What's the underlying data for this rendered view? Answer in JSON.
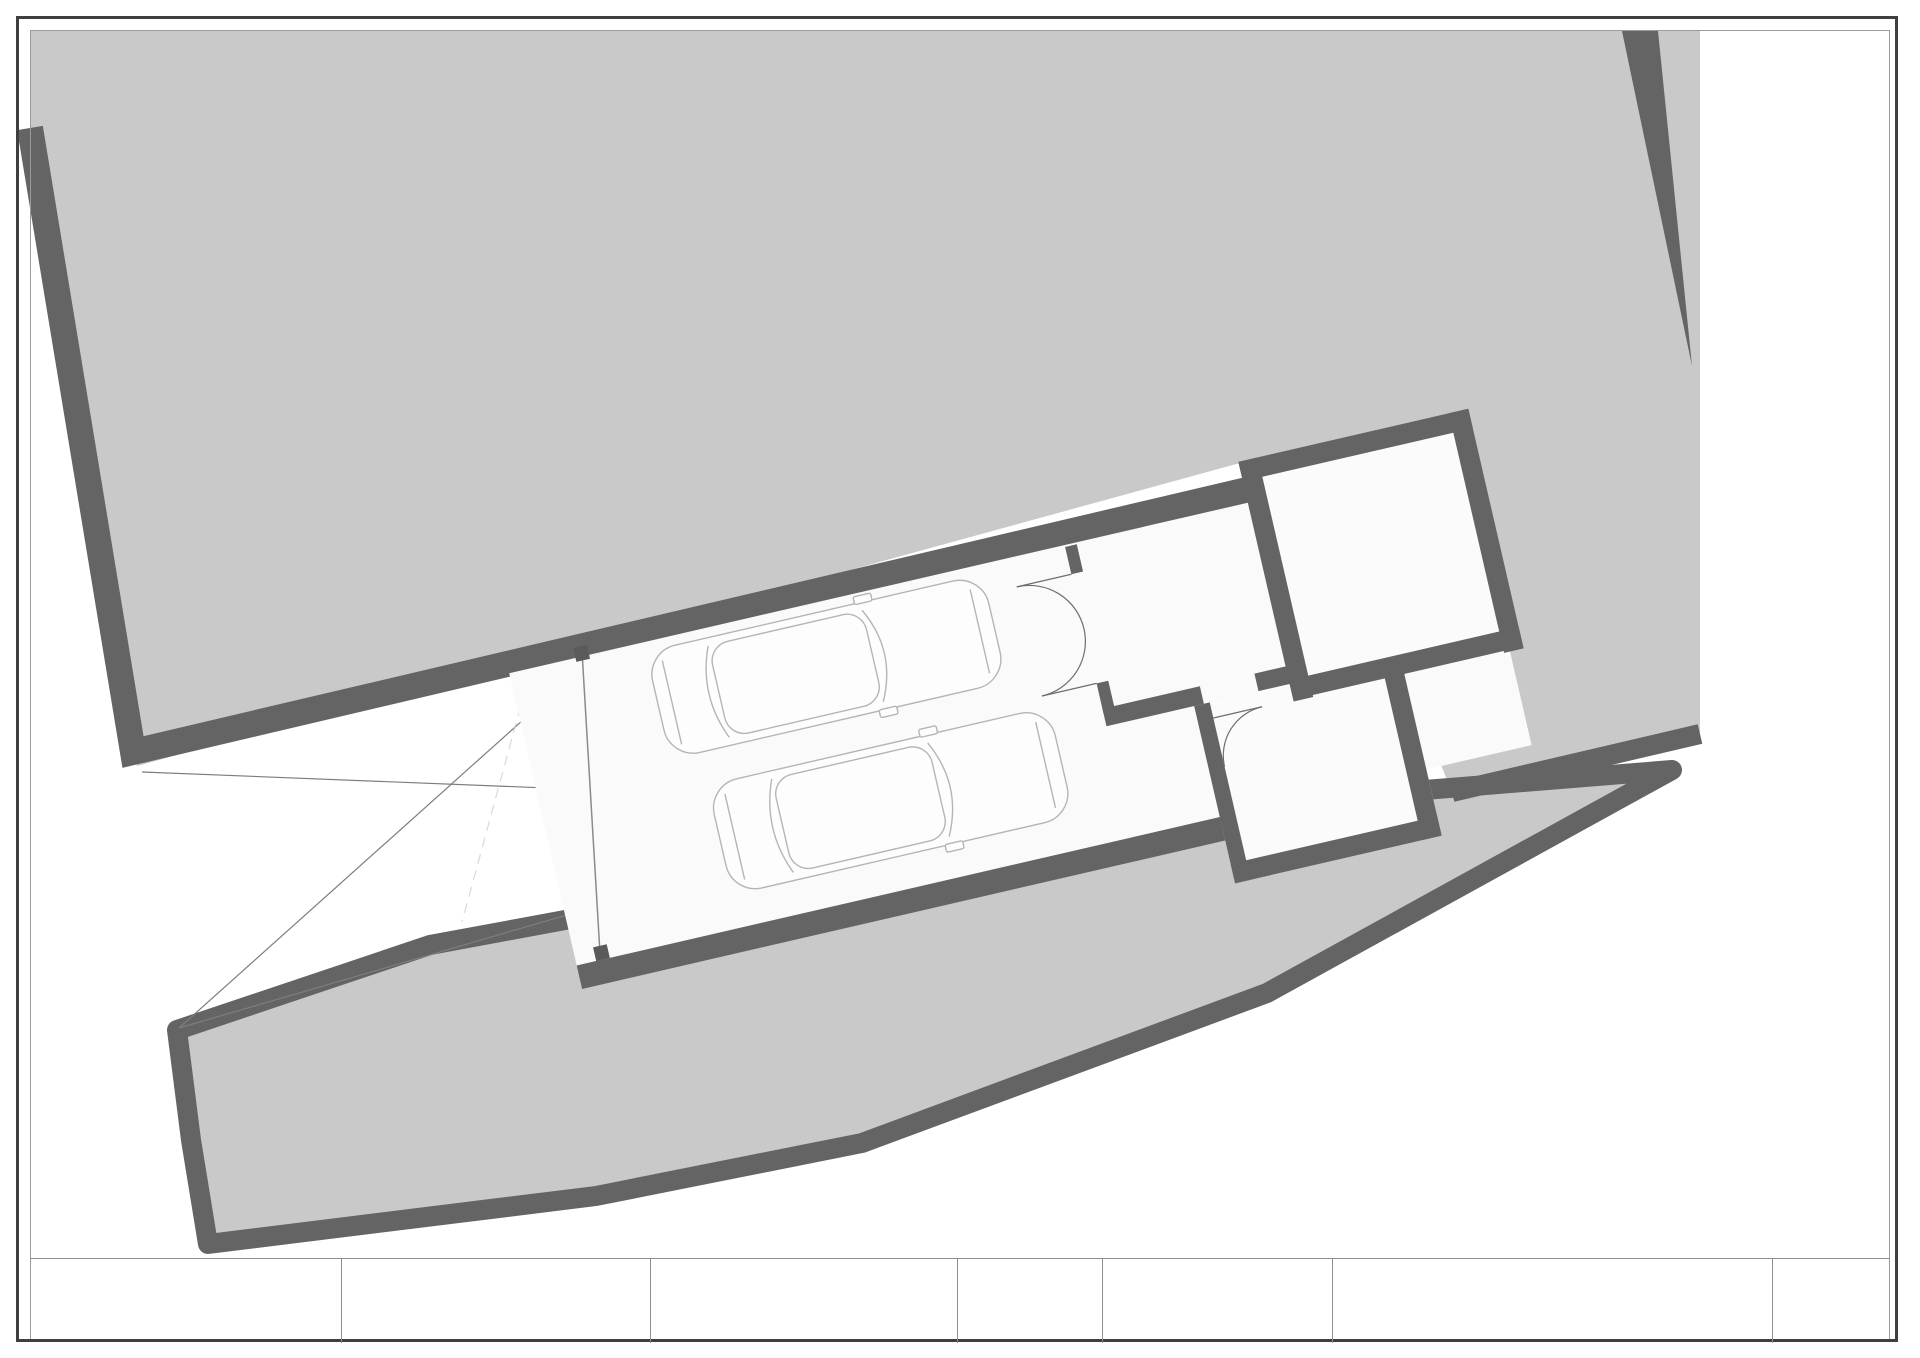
{
  "plan": {
    "rooms": {
      "garage": {
        "name": "Garage",
        "area": "64,708 m²"
      },
      "technical": {
        "name": "Technical room",
        "area": "15,488 m²",
        "tank_label": "3000 L"
      },
      "deposit": {
        "name": "Drinking water deposit",
        "area": "10,619 m²",
        "volume": "V = 30,00 m³"
      },
      "stairs": {
        "name": "Stairs",
        "area": "4,970 m²",
        "left_flight_numbers": [
          1,
          2,
          3,
          4,
          5,
          6
        ],
        "right_flight_numbers": [
          19,
          18,
          17,
          16,
          15,
          14,
          13,
          12,
          11,
          10,
          9
        ]
      }
    },
    "watermark": {
      "title": "JOHN TAYLOR",
      "subtitle": "LUXURY REAL ESTATE SIN"
    },
    "colors": {
      "terrain": "#c9c9c9",
      "wall": "#646464",
      "thin_line": "#8a8a8a",
      "accent_red": "#d2262b"
    }
  },
  "disclaimer": "*ESTOS PLANOS SON PARA EFECTO COMERCIALES, DE DISEÑO. DEBERÁ EFECTUARSE COMPROBACION URBANISTICA",
  "titleblock": {
    "proyecto_label": "PROYECTO:",
    "cliente_label": "CLIENTE:",
    "promotor_label": "PROMOTOR:",
    "escala_label": "ESCALA:",
    "escala_value": "1 100",
    "fecha_label": "FECHA:",
    "fecha_day": "31",
    "fecha_sup": "st",
    "fecha_rest": "May 2022",
    "plano_label": "PLANO:",
    "plano_value": "Garage",
    "numero_label": "N°:",
    "numero_value": "1"
  }
}
